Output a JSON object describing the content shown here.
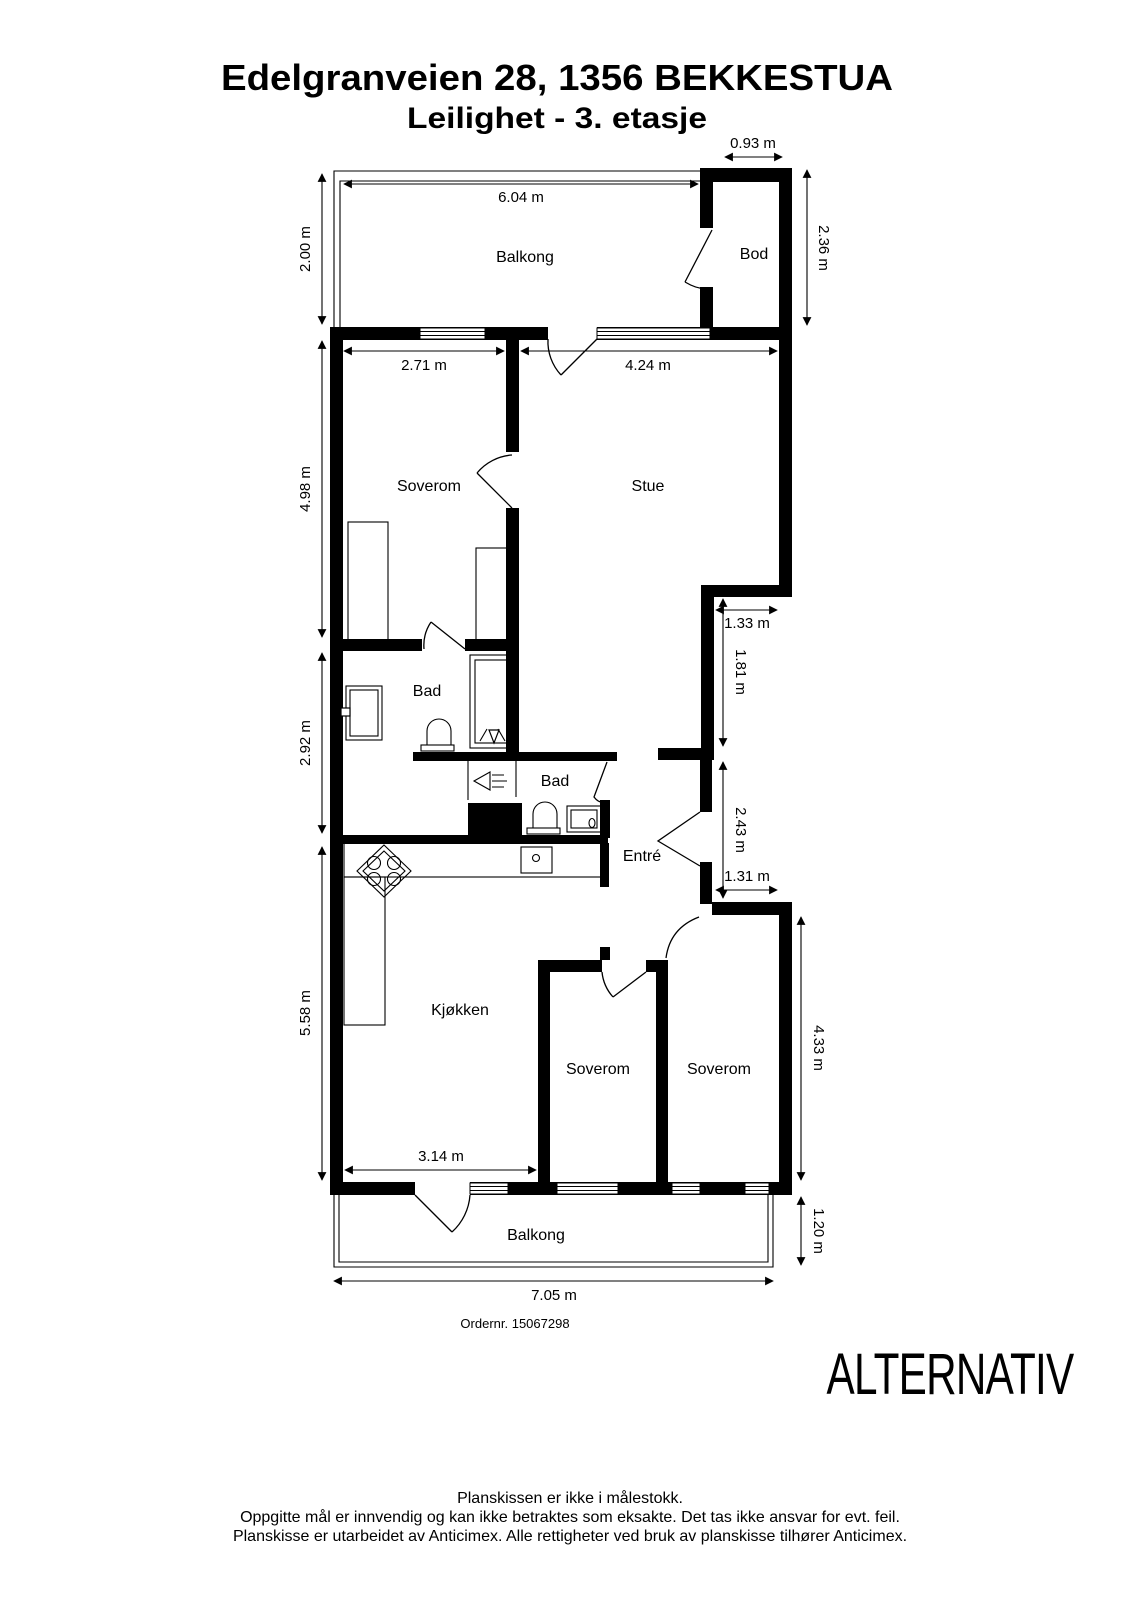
{
  "header": {
    "title": "Edelgranveien 28, 1356 BEKKESTUA",
    "subtitle": "Leilighet  - 3. etasje"
  },
  "floorplan": {
    "rooms": [
      {
        "id": "balkong-top",
        "label": "Balkong"
      },
      {
        "id": "bod",
        "label": "Bod"
      },
      {
        "id": "soverom-1",
        "label": "Soverom"
      },
      {
        "id": "stue",
        "label": "Stue"
      },
      {
        "id": "bad-1",
        "label": "Bad"
      },
      {
        "id": "bad-2",
        "label": "Bad"
      },
      {
        "id": "entre",
        "label": "Entré"
      },
      {
        "id": "kjokken",
        "label": "Kjøkken"
      },
      {
        "id": "soverom-2",
        "label": "Soverom"
      },
      {
        "id": "soverom-3",
        "label": "Soverom"
      },
      {
        "id": "balkong-bottom",
        "label": "Balkong"
      }
    ],
    "dimensions": [
      {
        "label": "0.93 m"
      },
      {
        "label": "6.04 m"
      },
      {
        "label": "2.00 m"
      },
      {
        "label": "2.36 m"
      },
      {
        "label": "2.71 m"
      },
      {
        "label": "4.24 m"
      },
      {
        "label": "4.98 m"
      },
      {
        "label": "1.33 m"
      },
      {
        "label": "1.81 m"
      },
      {
        "label": "2.92 m"
      },
      {
        "label": "2.43 m"
      },
      {
        "label": "1.31 m"
      },
      {
        "label": "5.58 m"
      },
      {
        "label": "4.33 m"
      },
      {
        "label": "3.14 m"
      },
      {
        "label": "1.20 m"
      },
      {
        "label": "7.05 m"
      }
    ]
  },
  "order_number_label": "Ordernr. 15067298",
  "watermark": "ALTERNATIV",
  "disclaimer": {
    "line1": "Planskissen er ikke i målestokk.",
    "line2": "Oppgitte mål er innvendig og kan ikke betraktes som eksakte. Det tas ikke ansvar for evt. feil.",
    "line3": "Planskisse er utarbeidet av Anticimex. Alle rettigheter ved bruk av planskisse tilhører Anticimex."
  },
  "colors": {
    "walls": "#000000",
    "background": "#ffffff",
    "text": "#000000"
  }
}
